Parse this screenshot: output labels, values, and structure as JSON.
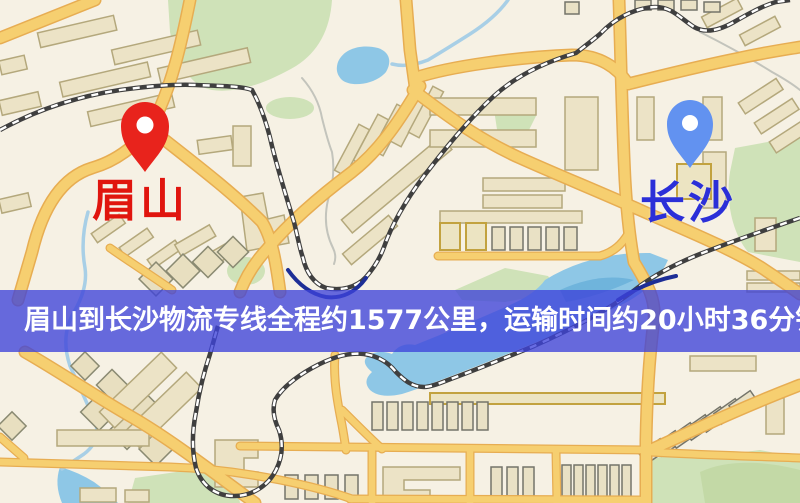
{
  "banner": {
    "text": "眉山到长沙物流专线全程约1577公里，运输时间约20小时36分钟.",
    "bg_color": "#3e42da",
    "text_color": "#ffffff"
  },
  "route": {
    "origin": "眉山",
    "destination": "长沙",
    "distance_km": "1577",
    "duration": "20小时36分钟"
  },
  "markers": {
    "origin": {
      "label": "眉山",
      "icon": "map-pin-icon",
      "pin_color": "#e8231c",
      "label_color": "#e0150e"
    },
    "destination": {
      "label": "长沙",
      "icon": "map-pin-icon",
      "pin_color": "#6292f0",
      "label_color": "#2b2fd8"
    }
  },
  "palette": {
    "map_background": "#f6f1e4",
    "road_fill": "#f6cf70",
    "road_casing": "#e7ad52",
    "water": "#8ec7e6",
    "park_green": "#cfe2b8",
    "building": "#ece3c6",
    "railway": "#3f3f3f"
  }
}
